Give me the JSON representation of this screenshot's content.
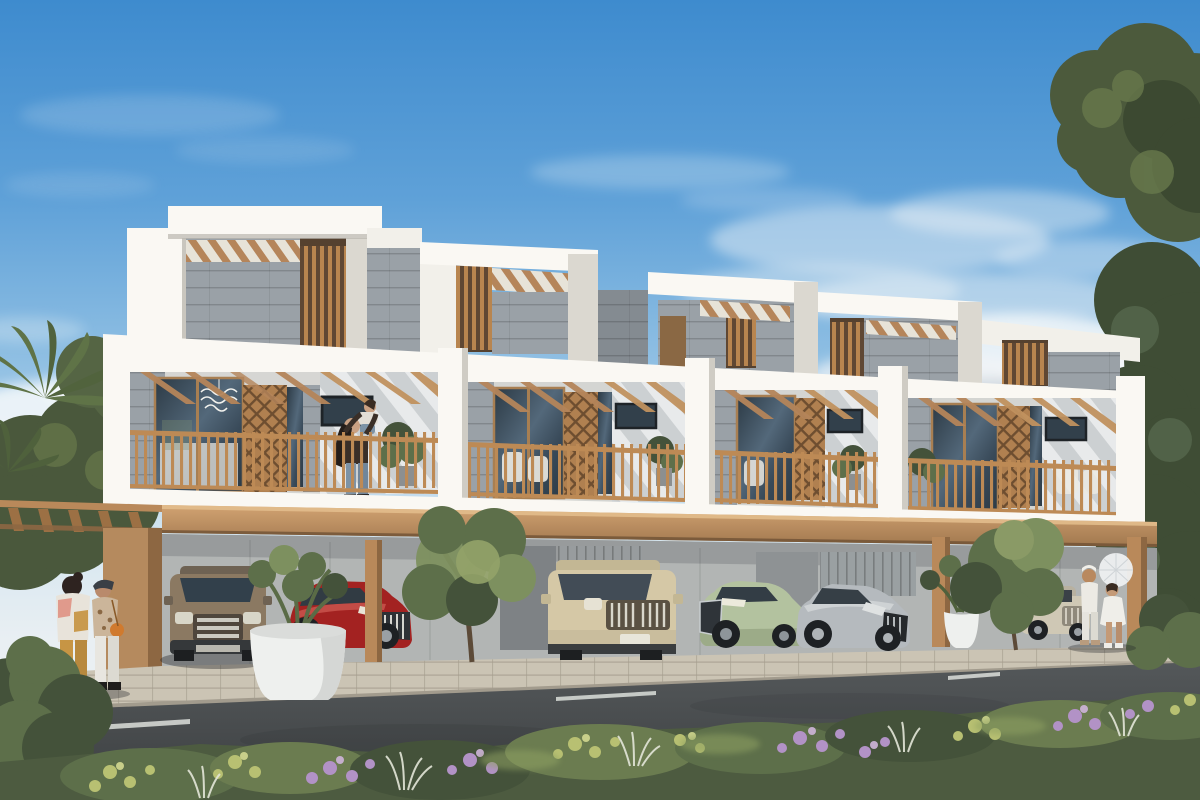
{
  "meta": {
    "description": "Daytime architectural rendering of a row of four modern white townhouses with grey stone panels, wooden louvers and rooftop pergolas. Each unit has a balcony with tan wood railings, lattice screens and plants; a woman lifts a child on the first balcony. A continuous tan carport canopy shelters parked cars: a bronze SUV, a red sedan, a champagne SUV, a light-green sedan, a silver coupe and a beige car. Two women chat on the left sidewalk beside a white planter; two women in white, one holding a lace parasol, stand on the right. A dark asphalt road with dashed lane markings crosses the foreground above beds of purple and yellow flowers and white grasses. Palm fronds frame the left edge and large leafy trees hang over the right."
  },
  "palette": {
    "sky-top": "#3e8bce",
    "sky-mid": "#8fbfe3",
    "sky-low": "#d7e7f0",
    "cloud-white": "#f6f8f9",
    "facade-white": "#f2f0ea",
    "facade-bright": "#faf8f3",
    "facade-shade": "#dbd8d0",
    "stone-grey": "#9aa1a7",
    "stone-dark": "#848b91",
    "wood-tan": "#b9895a",
    "wood-dark": "#8d6742",
    "railing-tan": "#bd8a55",
    "canopy-tan": "#c59a6b",
    "glass-dark": "#32404b",
    "ground-wall": "#b2b5b4",
    "road-asphalt": "#46494b",
    "sidewalk-paver": "#cbc4b4",
    "cobble-grey": "#8d959b",
    "foliage-dark": "#44523a",
    "foliage-mid": "#5d6f4a",
    "foliage-light": "#7d905f",
    "flower-purple": "#b292c6",
    "flower-yellow": "#b8c072",
    "grass-white": "#e3e6d8",
    "car-bronze": "#8b7962",
    "car-red": "#a32221",
    "car-champagne": "#d5c8a6",
    "car-green": "#b3c29f",
    "car-silver": "#b5babe",
    "car-beige": "#cfc8b5",
    "skin-tone": "#c49a77"
  },
  "scene": {
    "building": {
      "units": 4,
      "floors": 3,
      "elements": [
        "rooftop-pergola",
        "stone-panels",
        "wood-louvers",
        "balcony",
        "wood-railing",
        "lattice-screen",
        "pendant-lamp",
        "parking-canopy",
        "canopy-posts"
      ]
    },
    "vehicles": [
      {
        "name": "suv-bronze",
        "color": "#8b7962"
      },
      {
        "name": "sedan-red",
        "color": "#a32221"
      },
      {
        "name": "suv-champagne",
        "color": "#d5c8a6"
      },
      {
        "name": "sedan-green",
        "color": "#b3c29f"
      },
      {
        "name": "coupe-silver",
        "color": "#b5babe"
      },
      {
        "name": "sedan-beige",
        "color": "#cfc8b5"
      }
    ],
    "people": [
      {
        "name": "woman-mustard-pants",
        "location": "left-sidewalk"
      },
      {
        "name": "woman-beret-white-pants",
        "location": "left-sidewalk"
      },
      {
        "name": "woman-lifting-child",
        "location": "first-balcony"
      },
      {
        "name": "child-lifted",
        "location": "first-balcony"
      },
      {
        "name": "woman-white-outfit-turban",
        "location": "right-sidewalk"
      },
      {
        "name": "woman-white-dress-parasol",
        "location": "right-sidewalk"
      }
    ],
    "vegetation": [
      "palm-left",
      "hedge-left",
      "street-tree-center",
      "street-tree-right",
      "planter-left",
      "planter-right",
      "tree-canopy-top-right",
      "trees-right",
      "flower-bed-foreground"
    ],
    "road": {
      "lane_dashes": 3
    }
  }
}
